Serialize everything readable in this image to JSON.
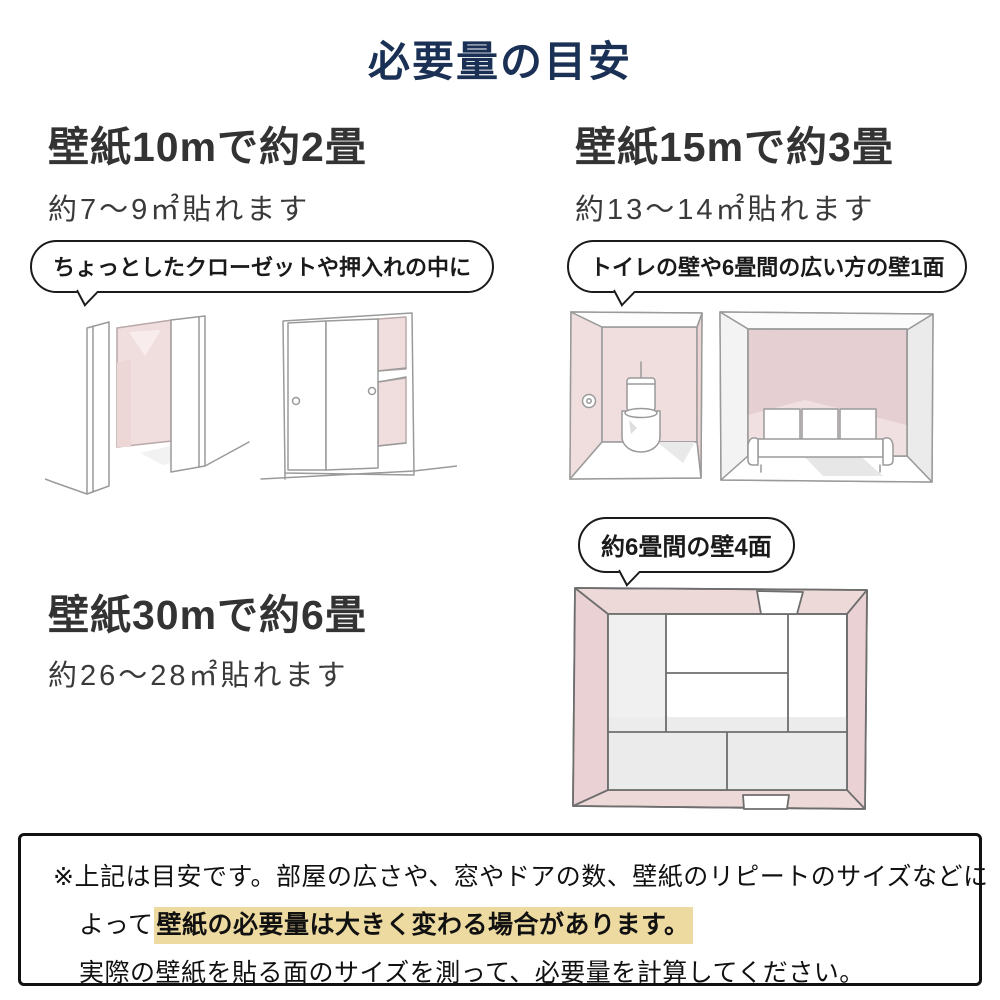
{
  "title": "必要量の目安",
  "colors": {
    "title_navy": "#1b3055",
    "heading_gray": "#333333",
    "pink_wall": "#f0dede",
    "pink_wall_dark": "#e5cfd3",
    "highlight_yellow": "#eddaa1"
  },
  "sections": [
    {
      "id": "10m",
      "heading": "壁紙10mで約2畳",
      "subtext": "約7〜9㎡貼れます",
      "bubble": "ちょっとしたクローゼットや押入れの中に",
      "illustrations": [
        "open-closet",
        "sliding-closet"
      ]
    },
    {
      "id": "15m",
      "heading": "壁紙15mで約3畳",
      "subtext": "約13〜14㎡貼れます",
      "bubble": "トイレの壁や6畳間の広い方の壁1面",
      "illustrations": [
        "toilet-room",
        "sofa-room"
      ]
    },
    {
      "id": "30m",
      "heading": "壁紙30mで約6畳",
      "subtext": "約26〜28㎡貼れます",
      "bubble": "約6畳間の壁4面",
      "illustrations": [
        "six-tatami-room-top-view"
      ]
    }
  ],
  "note": {
    "line1": "※上記は目安です。部屋の広さや、窓やドアの数、壁紙のリピートのサイズなどに",
    "line2_prefix": "よって",
    "line2_highlight": "壁紙の必要量は大きく変わる場合があります。",
    "line3": "実際の壁紙を貼る面のサイズを測って、必要量を計算してください。"
  }
}
